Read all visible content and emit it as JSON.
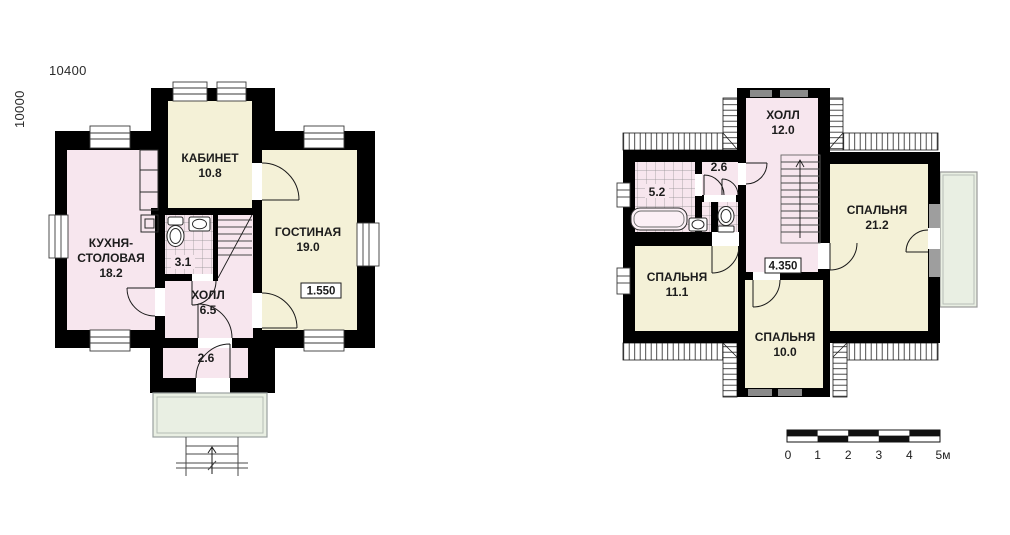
{
  "colors": {
    "wall": "#000000",
    "room_pink": "#f7e6ee",
    "room_cream": "#f4f1d7",
    "outdoor_green": "#e9efe3",
    "window_gray": "#8a8a8a",
    "text": "#1c1c1c"
  },
  "dimensions": {
    "width": "10400",
    "height": "10000"
  },
  "floor1": {
    "study": {
      "name": "КАБИНЕТ",
      "area": "10.8"
    },
    "living": {
      "name": "ГОСТИНАЯ",
      "area": "19.0"
    },
    "kitchen": {
      "name_line1": "КУХНЯ-",
      "name_line2": "СТОЛОВАЯ",
      "area": "18.2"
    },
    "hall": {
      "name": "ХОЛЛ",
      "area": "6.5"
    },
    "bathroom": {
      "area": "3.1"
    },
    "vestibule": {
      "area": "2.6"
    },
    "level_mark": "1.550"
  },
  "floor2": {
    "hall": {
      "name": "ХОЛЛ",
      "area": "12.0"
    },
    "bedroom_large": {
      "name": "СПАЛЬНЯ",
      "area": "21.2"
    },
    "bedroom_mid": {
      "name": "СПАЛЬНЯ",
      "area": "11.1"
    },
    "bedroom_small": {
      "name": "СПАЛЬНЯ",
      "area": "10.0"
    },
    "bathroom": {
      "area": "5.2"
    },
    "closet": {
      "area": "2.6"
    },
    "level_mark": "4.350"
  },
  "scale_bar": {
    "labels": [
      "0",
      "1",
      "2",
      "3",
      "4",
      "5м"
    ]
  }
}
